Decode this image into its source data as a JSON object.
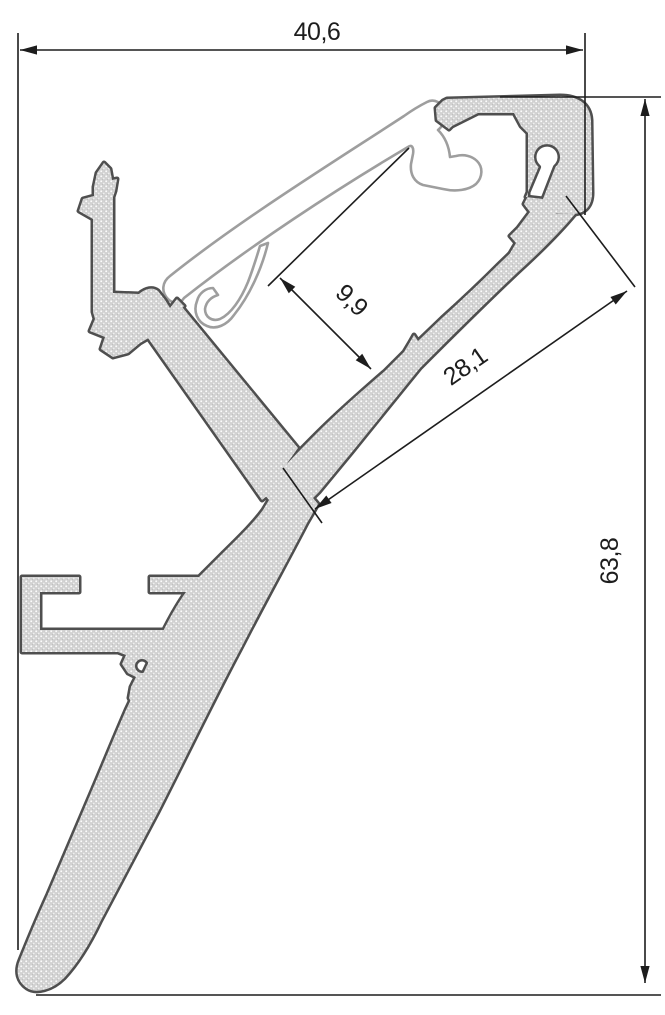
{
  "drawing": {
    "dimension_labels": {
      "top_width": "40,6",
      "channel_depth": "9,9",
      "slant_face_length": "28,1",
      "total_height": "63,8"
    },
    "colors": {
      "background": "#ffffff",
      "profile_outline": "#4f4f4f",
      "profile_fill": "#d2d2d2",
      "diffuser_outline": "#9e9e9e",
      "dimension_lines": "#1d1d1d"
    }
  }
}
